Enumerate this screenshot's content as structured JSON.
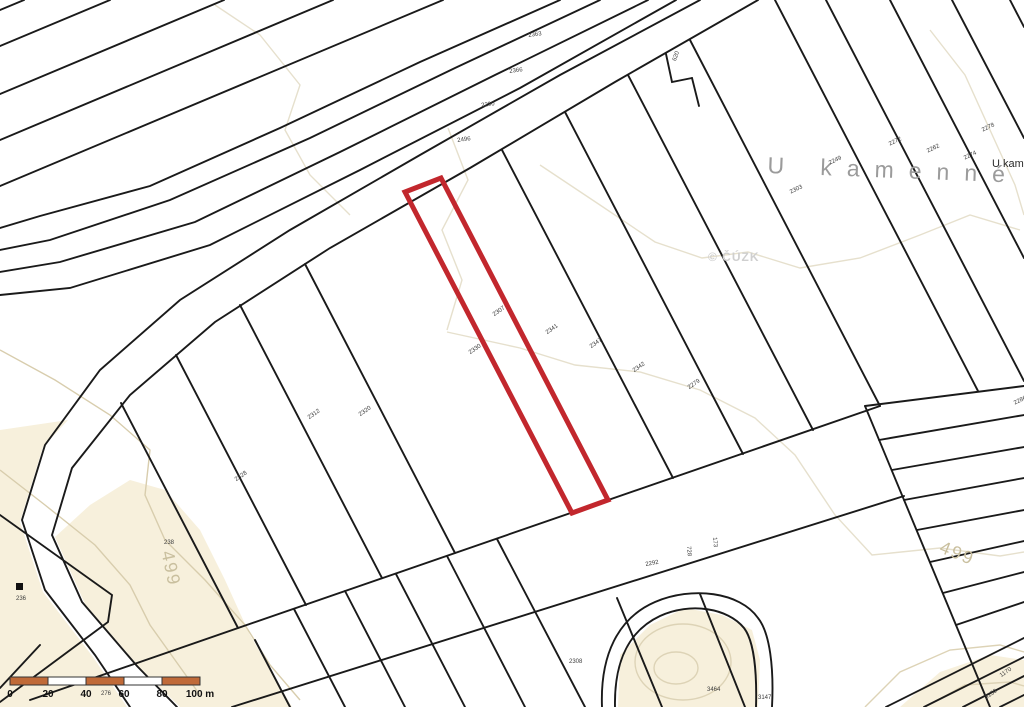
{
  "map": {
    "place_name": "U kamenné",
    "corner_place_name": "U kam",
    "copyright": "© ČÚZK",
    "highlight_color": "#c2272d",
    "line_color": "#1a1a1a",
    "terrain_fill": "#f7f0dc",
    "scale_bar": {
      "unit": "m",
      "ticks": [
        "0",
        "20",
        "40",
        "60",
        "80",
        "100"
      ],
      "bar_color": "#c06a38",
      "segment_meters": 20
    },
    "contour_labels": [
      {
        "text": "499",
        "x": 176,
        "y": 549,
        "rot": 78
      },
      {
        "text": "499",
        "x": 944,
        "y": 538,
        "rot": 22
      }
    ],
    "parcel_numbers": [
      {
        "text": "2363",
        "x": 528,
        "y": 33,
        "rot": -8
      },
      {
        "text": "2366",
        "x": 509,
        "y": 69,
        "rot": -8
      },
      {
        "text": "2290",
        "x": 481,
        "y": 103,
        "rot": -8
      },
      {
        "text": "2496",
        "x": 457,
        "y": 138,
        "rot": -8
      },
      {
        "text": "620",
        "x": 672,
        "y": 60,
        "rot": -70
      },
      {
        "text": "2272",
        "x": 888,
        "y": 142,
        "rot": -25
      },
      {
        "text": "2262",
        "x": 926,
        "y": 149,
        "rot": -25
      },
      {
        "text": "2274",
        "x": 963,
        "y": 156,
        "rot": -25
      },
      {
        "text": "2278",
        "x": 981,
        "y": 128,
        "rot": -25
      },
      {
        "text": "2249",
        "x": 828,
        "y": 161,
        "rot": -25
      },
      {
        "text": "2303",
        "x": 789,
        "y": 190,
        "rot": -25
      },
      {
        "text": "2307",
        "x": 492,
        "y": 313,
        "rot": -35
      },
      {
        "text": "2341",
        "x": 545,
        "y": 331,
        "rot": -35
      },
      {
        "text": "2347",
        "x": 589,
        "y": 345,
        "rot": -35
      },
      {
        "text": "2342",
        "x": 632,
        "y": 369,
        "rot": -35
      },
      {
        "text": "2279",
        "x": 687,
        "y": 386,
        "rot": -35
      },
      {
        "text": "2330",
        "x": 468,
        "y": 351,
        "rot": -35
      },
      {
        "text": "2312",
        "x": 307,
        "y": 416,
        "rot": -35
      },
      {
        "text": "2320",
        "x": 358,
        "y": 413,
        "rot": -35
      },
      {
        "text": "2328",
        "x": 234,
        "y": 478,
        "rot": -35
      },
      {
        "text": "238",
        "x": 164,
        "y": 540,
        "rot": 0
      },
      {
        "text": "236",
        "x": 16,
        "y": 596,
        "rot": 0
      },
      {
        "text": "2286",
        "x": 1013,
        "y": 401,
        "rot": -25
      },
      {
        "text": "173",
        "x": 717,
        "y": 537,
        "rot": 85
      },
      {
        "text": "728",
        "x": 691,
        "y": 546,
        "rot": 85
      },
      {
        "text": "2292",
        "x": 645,
        "y": 562,
        "rot": -10
      },
      {
        "text": "2308",
        "x": 569,
        "y": 659,
        "rot": 0
      },
      {
        "text": "3464",
        "x": 707,
        "y": 687,
        "rot": 0
      },
      {
        "text": "3147",
        "x": 758,
        "y": 695,
        "rot": 0
      },
      {
        "text": "1170",
        "x": 999,
        "y": 674,
        "rot": -35
      },
      {
        "text": "3150",
        "x": 984,
        "y": 696,
        "rot": -35
      },
      {
        "text": "276",
        "x": 101,
        "y": 691,
        "rot": 0
      }
    ]
  }
}
